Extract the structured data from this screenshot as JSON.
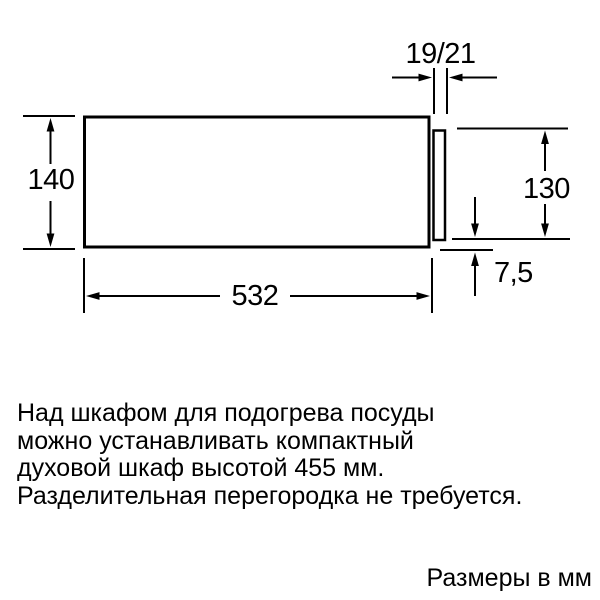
{
  "diagram": {
    "title": "appliance installation dimension drawing",
    "labels": {
      "top_panel_thickness": "19/21",
      "left_niche_height": "140",
      "right_front_height": "130",
      "bottom_width": "532",
      "bottom_offset": "7,5"
    }
  },
  "notes": {
    "lines": [
      "Над шкафом для подогрева посуды",
      "можно устанавливать компактный",
      "духовой шкаф высотой 455 мм.",
      "Разделительная перегородка не требуется."
    ]
  },
  "footer": {
    "units": "Размеры в мм"
  },
  "colors": {
    "line": "#000000",
    "background": "#ffffff",
    "text": "#000000"
  }
}
